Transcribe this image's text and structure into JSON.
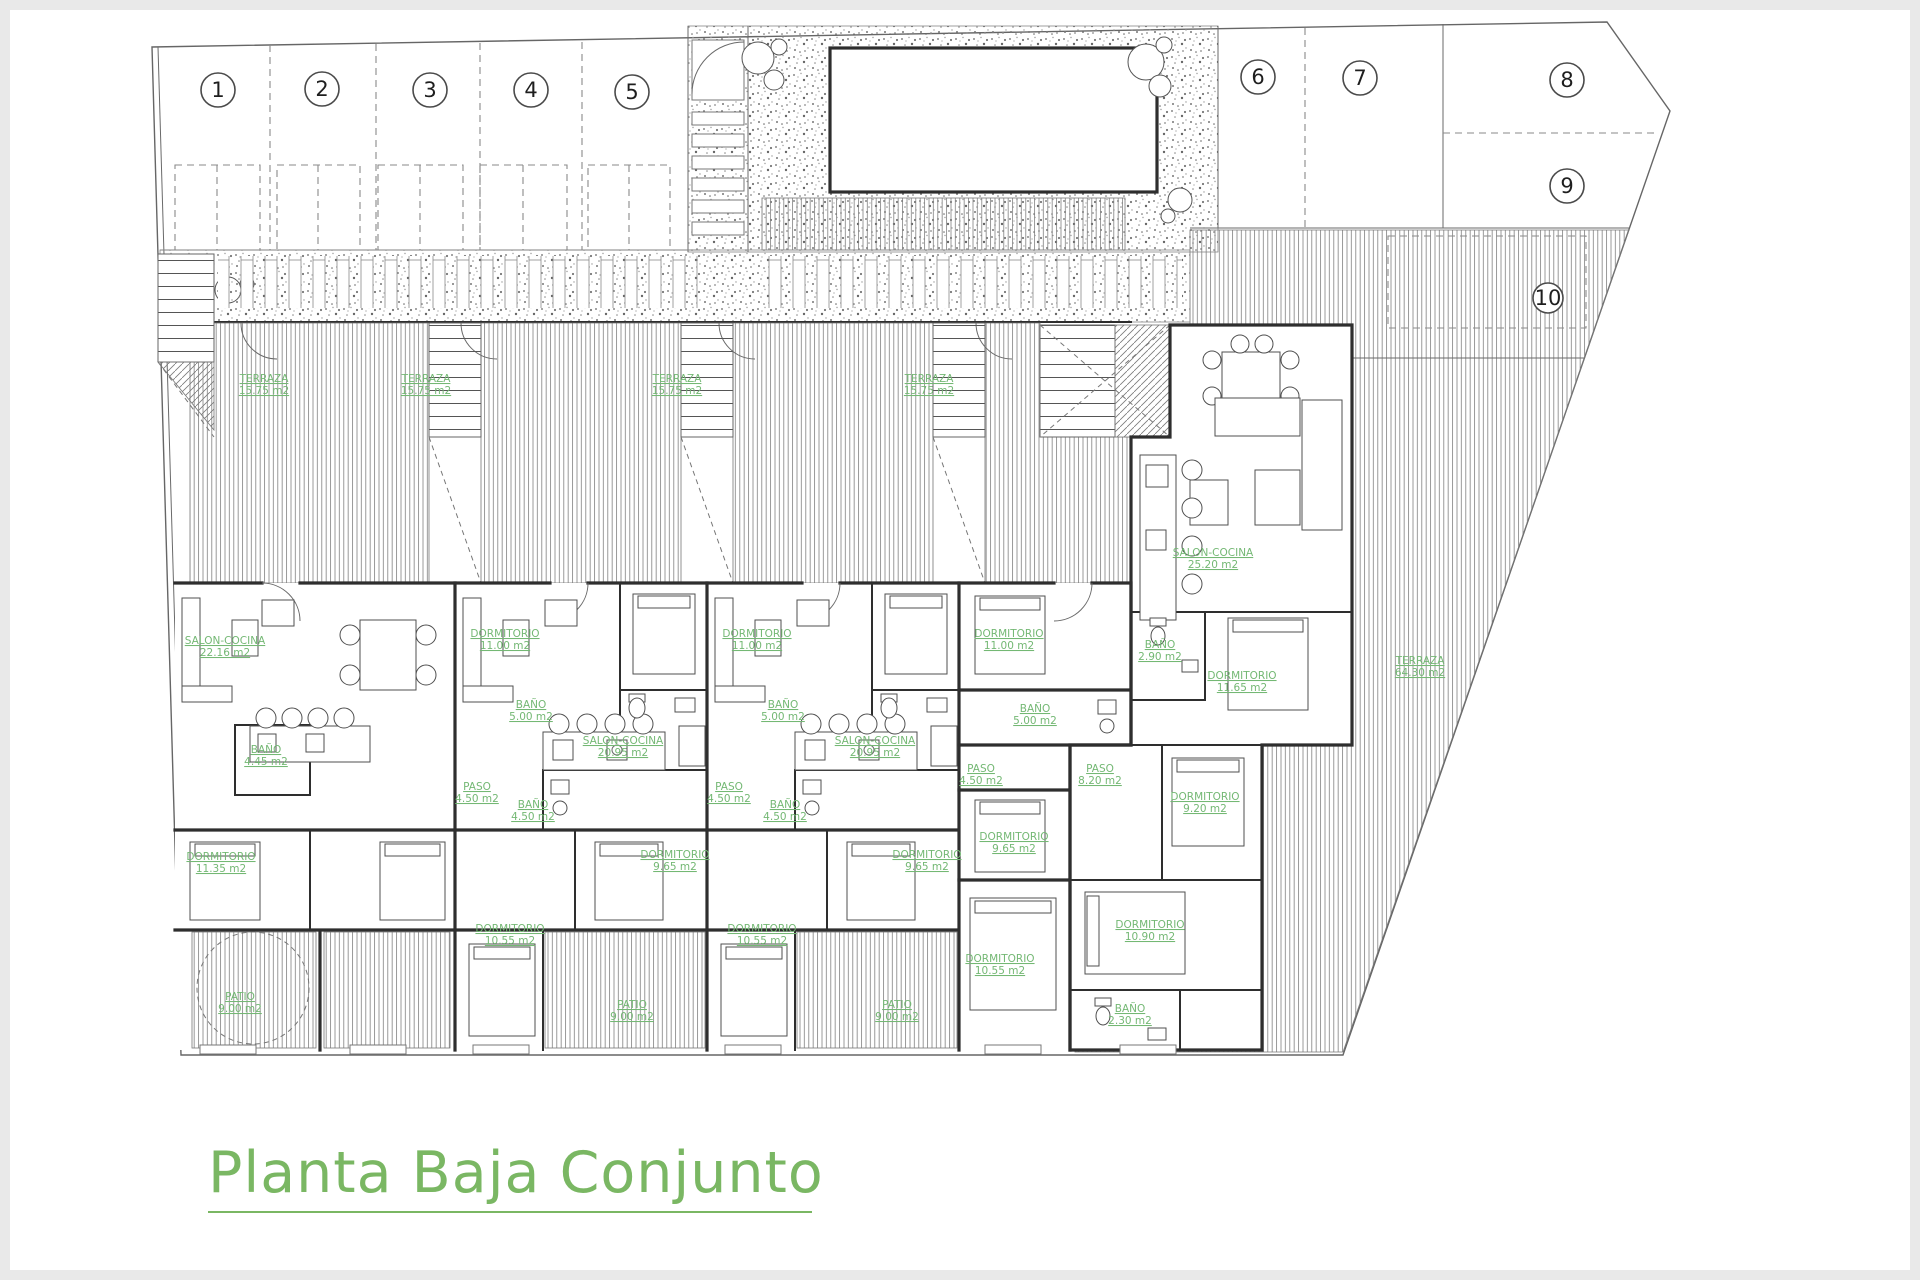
{
  "meta": {
    "title": "Planta Baja Conjunto"
  },
  "colors": {
    "label_green": "#74b874",
    "title_green": "#7ab763",
    "wall_dark": "#2e2e2e",
    "hatch_gray": "#8a8a8a"
  },
  "parking": {
    "spaces": [
      {
        "label": "1"
      },
      {
        "label": "2"
      },
      {
        "label": "3"
      },
      {
        "label": "4"
      },
      {
        "label": "5"
      },
      {
        "label": "6"
      },
      {
        "label": "7"
      },
      {
        "label": "8"
      },
      {
        "label": "9"
      },
      {
        "label": "10"
      }
    ]
  },
  "units": [
    {
      "id": "unit-1",
      "rooms": [
        {
          "name": "TERRAZA",
          "area": "15.75 m2"
        },
        {
          "name": "SALON-COCINA",
          "area": "22.16 m2"
        },
        {
          "name": "BAÑO",
          "area": "4.45 m2"
        },
        {
          "name": "DORMITORIO",
          "area": "11.35 m2"
        },
        {
          "name": "PATIO",
          "area": "9.00 m2"
        }
      ]
    },
    {
      "id": "unit-2",
      "rooms": [
        {
          "name": "TERRAZA",
          "area": "15.75 m2"
        },
        {
          "name": "DORMITORIO",
          "area": "11.00 m2"
        },
        {
          "name": "BAÑO",
          "area": "5.00 m2"
        },
        {
          "name": "SALON-COCINA",
          "area": "20.95 m2"
        },
        {
          "name": "PASO",
          "area": "4.50 m2"
        },
        {
          "name": "BAÑO",
          "area": "4.50 m2"
        },
        {
          "name": "DORMITORIO",
          "area": "9.65 m2"
        },
        {
          "name": "DORMITORIO",
          "area": "10.55 m2"
        },
        {
          "name": "PATIO",
          "area": "9.00 m2"
        }
      ]
    },
    {
      "id": "unit-3",
      "rooms": [
        {
          "name": "TERRAZA",
          "area": "15.75 m2"
        },
        {
          "name": "DORMITORIO",
          "area": "11.00 m2"
        },
        {
          "name": "BAÑO",
          "area": "5.00 m2"
        },
        {
          "name": "SALON-COCINA",
          "area": "20.95 m2"
        },
        {
          "name": "PASO",
          "area": "4.50 m2"
        },
        {
          "name": "BAÑO",
          "area": "4.50 m2"
        },
        {
          "name": "DORMITORIO",
          "area": "9.65 m2"
        },
        {
          "name": "DORMITORIO",
          "area": "10.55 m2"
        },
        {
          "name": "PATIO",
          "area": "9.00 m2"
        }
      ]
    },
    {
      "id": "unit-4",
      "rooms": [
        {
          "name": "TERRAZA",
          "area": "15.75 m2"
        },
        {
          "name": "DORMITORIO",
          "area": "11.00 m2"
        },
        {
          "name": "BAÑO",
          "area": "5.00 m2"
        },
        {
          "name": "PASO",
          "area": "4.50 m2"
        },
        {
          "name": "DORMITORIO",
          "area": "9.65 m2"
        },
        {
          "name": "DORMITORIO",
          "area": "10.55 m2"
        }
      ]
    },
    {
      "id": "unit-east",
      "rooms": [
        {
          "name": "SALON-COCINA",
          "area": "25.20 m2"
        },
        {
          "name": "BAÑO",
          "area": "2.90 m2"
        },
        {
          "name": "DORMITORIO",
          "area": "11.65 m2"
        },
        {
          "name": "PASO",
          "area": "8.20 m2"
        },
        {
          "name": "DORMITORIO",
          "area": "9.20 m2"
        },
        {
          "name": "DORMITORIO",
          "area": "10.90 m2"
        },
        {
          "name": "BAÑO",
          "area": "2.30 m2"
        },
        {
          "name": "TERRAZA",
          "area": "64.30 m2"
        }
      ]
    }
  ]
}
